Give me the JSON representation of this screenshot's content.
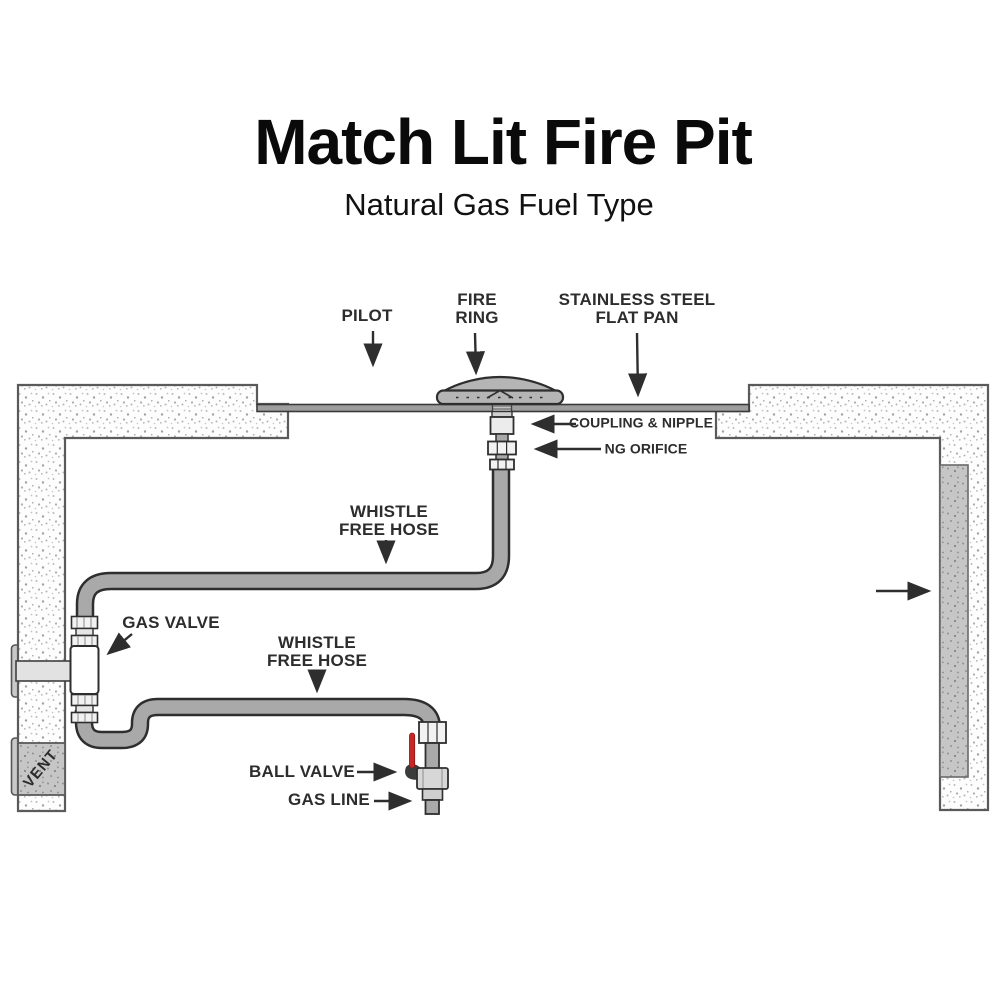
{
  "title": "Match Lit Fire Pit",
  "subtitle": "Natural Gas Fuel Type",
  "labels": {
    "pilot": "PILOT",
    "fire_ring": "FIRE\nRING",
    "flat_pan": "STAINLESS STEEL\nFLAT PAN",
    "coupling_nipple": "COUPLING & NIPPLE",
    "ng_orifice": "NG ORIFICE",
    "whistle_free_hose_upper": "WHISTLE\nFREE HOSE",
    "gas_valve": "GAS VALVE",
    "whistle_free_hose_lower": "WHISTLE\nFREE HOSE",
    "ball_valve": "BALL VALVE",
    "gas_line": "GAS LINE",
    "vent": "VENT"
  },
  "colors": {
    "outline": "#2e2e2e",
    "hose_gray": "#a9a9a9",
    "pan_gray": "#9e9e9e",
    "wall_stroke": "#5a5a5a",
    "fitting_fill": "#f2f2f2",
    "valve_body_fill": "#ffffff",
    "ball_valve_fill": "#d7d7d7",
    "valve_handle_red": "#c62828",
    "label_text": "#2d2d2d"
  }
}
